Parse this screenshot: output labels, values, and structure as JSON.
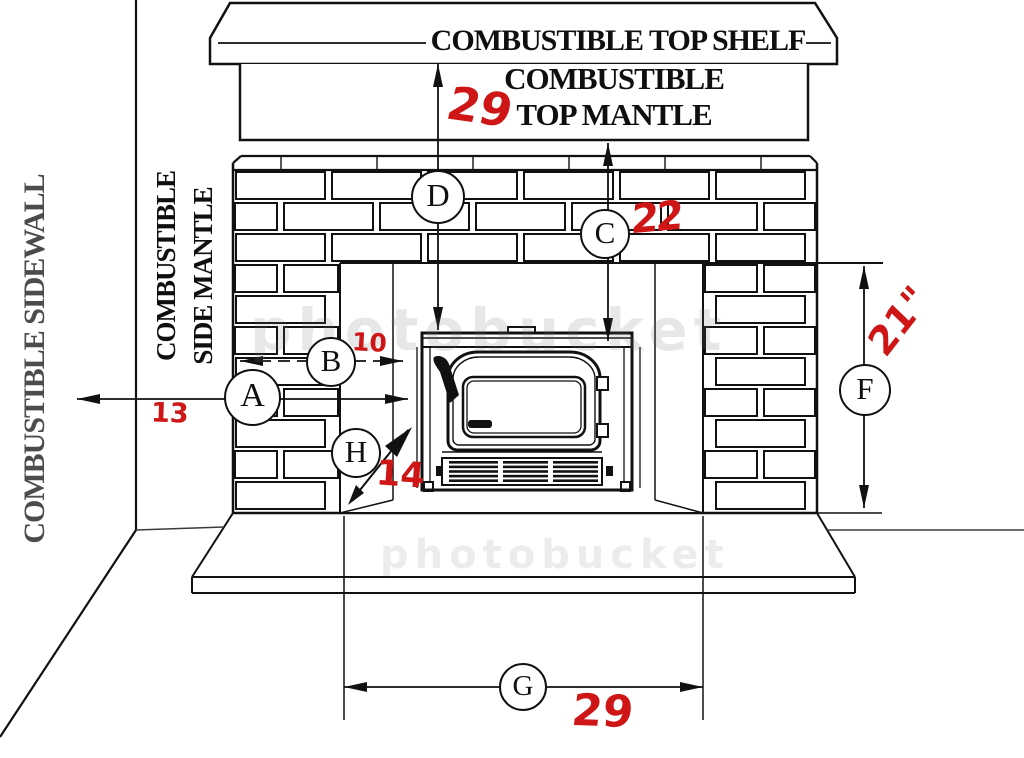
{
  "diagram": {
    "labels": {
      "top_shelf": "COMBUSTIBLE TOP SHELF",
      "top_mantle_line1": "COMBUSTIBLE",
      "top_mantle_line2": "TOP MANTLE",
      "sidewall": "COMBUSTIBLE SIDEWALL",
      "side_mantle_line1": "COMBUSTIBLE",
      "side_mantle_line2": "SIDE MANTLE"
    },
    "dims": {
      "A": {
        "letter": "A",
        "value": "13"
      },
      "B": {
        "letter": "B",
        "value": "10"
      },
      "C": {
        "letter": "C",
        "value": "22"
      },
      "D": {
        "letter": "D",
        "value": "29"
      },
      "F": {
        "letter": "F",
        "value": "21\""
      },
      "G": {
        "letter": "G",
        "value": "29"
      },
      "H": {
        "letter": "H",
        "value": "14"
      }
    },
    "watermark": "photobucket",
    "colors": {
      "ink": "#111111",
      "annotation_red": "#cf1616",
      "sidewall_gray": "#4c4c4c"
    }
  }
}
